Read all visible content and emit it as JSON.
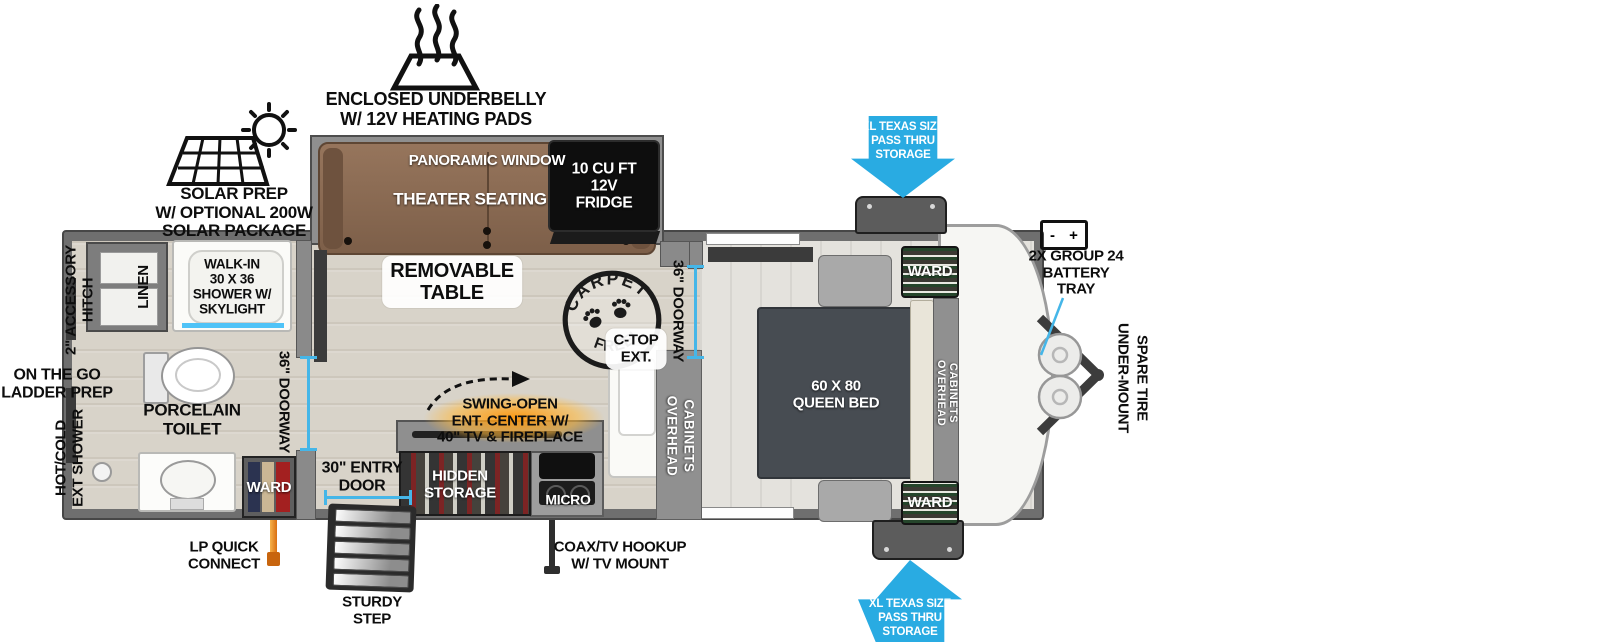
{
  "colors": {
    "arrow_blue": "#29ABE2",
    "measure_cyan": "#45B6E8",
    "lp_orange": "#E07B1F",
    "fire_glow": "#FF9614",
    "couch_brown": "#8A6A52",
    "bed_gray": "#474C52",
    "wall_gray": "#6F6F6F",
    "floor_beige": "#D8D3C9"
  },
  "exterior": {
    "underbelly": {
      "l1": "ENCLOSED UNDERBELLY",
      "l2": "W/ 12V HEATING PADS"
    },
    "solar": {
      "l1": "SOLAR PREP",
      "l2": "W/ OPTIONAL 200W",
      "l3": "SOLAR PACKAGE"
    },
    "pass_thru_top": {
      "l1": "XL TEXAS SIZE",
      "l2": "PASS THRU",
      "l3": "STORAGE"
    },
    "pass_thru_bottom": {
      "l1": "XL TEXAS SIZE",
      "l2": "PASS THRU",
      "l3": "STORAGE"
    },
    "battery": {
      "l1": "2X GROUP 24",
      "l2": "BATTERY",
      "l3": "TRAY",
      "minus": "-",
      "plus": "+"
    },
    "spare_tire": {
      "l1": "UNDER-MOUNT",
      "l2": "SPARE TIRE"
    },
    "accessory_hitch": {
      "l1": "2\" ACCESSORY",
      "l2": "HITCH"
    },
    "ladder_prep": {
      "l1": "ON THE GO",
      "l2": "LADDER PREP"
    },
    "ext_shower": {
      "l1": "HOT/COLD",
      "l2": "EXT SHOWER"
    },
    "lp_connect": {
      "l1": "LP QUICK",
      "l2": "CONNECT"
    },
    "sturdy_step": {
      "l1": "STURDY",
      "l2": "STEP"
    },
    "coax": {
      "l1": "COAX/TV HOOKUP",
      "l2": "W/ TV MOUNT"
    },
    "entry_door": {
      "l1": "30\" ENTRY",
      "l2": "DOOR"
    }
  },
  "living": {
    "panoramic_window": "PANORAMIC WINDOW",
    "theater_seating": "THEATER SEATING",
    "fridge": {
      "l1": "10 CU FT",
      "l2": "12V",
      "l3": "FRIDGE"
    },
    "removable_table": {
      "l1": "REMOVABLE",
      "l2": "TABLE"
    },
    "carpet_free": {
      "top": "CARPET",
      "bottom": "FREE!"
    },
    "swing_open": {
      "l1": "SWING-OPEN",
      "l2": "ENT. CENTER W/",
      "l3": "40\" TV & FIREPLACE"
    },
    "hidden_storage": {
      "l1": "HIDDEN",
      "l2": "STORAGE"
    },
    "micro": "MICRO"
  },
  "kitchen": {
    "ctop_ext": {
      "l1": "C-TOP",
      "l2": "EXT."
    },
    "overhead_cabinets": {
      "w1": "OVERHEAD",
      "w2": "CABINETS"
    },
    "doorway": "36\" DOORWAY"
  },
  "bedroom": {
    "bed": {
      "l1": "60 X 80",
      "l2": "QUEEN BED"
    },
    "ward_top": "WARD",
    "ward_bottom": "WARD",
    "overhead_cabinets": {
      "w1": "OVERHEAD",
      "w2": "CABINETS"
    }
  },
  "bathroom": {
    "linen": "LINEN",
    "shower": {
      "l1": "WALK-IN",
      "l2": "30 X 36",
      "l3": "SHOWER W/",
      "l4": "SKYLIGHT"
    },
    "toilet": {
      "l1": "PORCELAIN",
      "l2": "TOILET"
    },
    "doorway": "36\" DOORWAY",
    "ward": "WARD"
  }
}
